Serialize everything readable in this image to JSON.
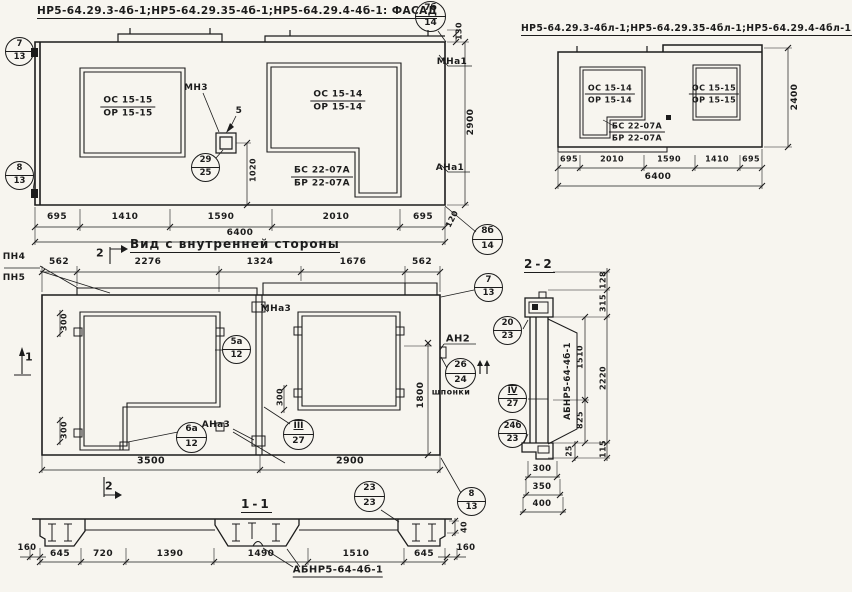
{
  "colors": {
    "ink": "#1c1c1c",
    "paper": "#f7f5ef"
  },
  "titles": {
    "facade_left": "НР5-64.29.3-4б-1;НР5-64.29.35-4б-1;НР5-64.29.4-4б-1: ФАСАД",
    "facade_right": "НР5-64.29.3-4бл-1;НР5-64.29.35-4бл-1;НР5-64.29.4-4бл-1.ФАСАД",
    "inner_view": "Вид с внутренней стороны",
    "section_2_2": "2-2",
    "section_1_1": "1-1"
  },
  "fractions": [
    {
      "top": "ОС 15-15",
      "bottom": "ОР 15-15",
      "x": 128,
      "y": 107,
      "small": false
    },
    {
      "top": "ОС 15-14",
      "bottom": "ОР 15-14",
      "x": 338,
      "y": 101,
      "small": false
    },
    {
      "top": "БС 22-07А",
      "bottom": "БР 22-07А",
      "x": 322,
      "y": 177,
      "small": false
    },
    {
      "top": "ОС 15-14",
      "bottom": "ОР 15-14",
      "x": 610,
      "y": 94,
      "small": true
    },
    {
      "top": "ОС 15-15",
      "bottom": "ОР 15-15",
      "x": 714,
      "y": 94,
      "small": true
    },
    {
      "top": "БС 22-07А",
      "bottom": "БР 22-07А",
      "x": 637,
      "y": 132,
      "small": true
    }
  ],
  "balloons": [
    {
      "top": "7б",
      "bottom": "14",
      "x": 431,
      "y": 17,
      "r": 16
    },
    {
      "top": "7",
      "bottom": "13",
      "x": 20,
      "y": 52,
      "r": 15
    },
    {
      "top": "8",
      "bottom": "13",
      "x": 20,
      "y": 176,
      "r": 15
    },
    {
      "top": "29",
      "bottom": "25",
      "x": 206,
      "y": 168,
      "r": 15
    },
    {
      "top": "8б",
      "bottom": "14",
      "x": 488,
      "y": 240,
      "r": 16
    },
    {
      "top": "5а",
      "bottom": "12",
      "x": 237,
      "y": 350,
      "r": 15
    },
    {
      "top": "6а",
      "bottom": "12",
      "x": 192,
      "y": 438,
      "r": 16
    },
    {
      "top": "III",
      "bottom": "27",
      "x": 299,
      "y": 435,
      "r": 16,
      "roman": true
    },
    {
      "top": "7",
      "bottom": "13",
      "x": 489,
      "y": 288,
      "r": 15
    },
    {
      "top": "26",
      "bottom": "24",
      "x": 461,
      "y": 374,
      "r": 16
    },
    {
      "top": "20",
      "bottom": "23",
      "x": 508,
      "y": 331,
      "r": 15
    },
    {
      "top": "IV",
      "bottom": "27",
      "x": 513,
      "y": 399,
      "r": 15,
      "roman": true
    },
    {
      "top": "24б",
      "bottom": "23",
      "x": 513,
      "y": 434,
      "r": 15
    },
    {
      "top": "23",
      "bottom": "23",
      "x": 370,
      "y": 497,
      "r": 16
    },
    {
      "top": "8",
      "bottom": "13",
      "x": 472,
      "y": 502,
      "r": 15
    }
  ],
  "texts": [
    {
      "t": "130",
      "x": 459,
      "y": 31,
      "rot": -90,
      "fs": 8,
      "name": "dim-parapet-130"
    },
    {
      "t": "МНа1",
      "x": 452,
      "y": 62,
      "fs": 9,
      "name": "anchor-label-mna1"
    },
    {
      "t": "2900",
      "x": 471,
      "y": 122,
      "rot": -90,
      "fs": 9,
      "name": "dim-height-2900"
    },
    {
      "t": "АНа1",
      "x": 450,
      "y": 168,
      "fs": 9,
      "name": "anchor-label-ana1"
    },
    {
      "t": "120",
      "x": 452,
      "y": 219,
      "rot": -62,
      "fs": 8,
      "name": "dim-120"
    },
    {
      "t": "МН3",
      "x": 196,
      "y": 88,
      "fs": 9,
      "name": "anchor-label-mn3"
    },
    {
      "t": "5",
      "x": 239,
      "y": 111,
      "fs": 9,
      "name": "dim-5"
    },
    {
      "t": "1020",
      "x": 253,
      "y": 170,
      "rot": -90,
      "fs": 8,
      "name": "dim-1020"
    },
    {
      "t": "695",
      "x": 57,
      "y": 217,
      "fs": 9,
      "name": "dim-695"
    },
    {
      "t": "1410",
      "x": 125,
      "y": 217,
      "fs": 9,
      "name": "dim-1410"
    },
    {
      "t": "1590",
      "x": 221,
      "y": 217,
      "fs": 9,
      "name": "dim-1590"
    },
    {
      "t": "2010",
      "x": 336,
      "y": 217,
      "fs": 9,
      "name": "dim-2010"
    },
    {
      "t": "695",
      "x": 423,
      "y": 217,
      "fs": 9,
      "name": "dim-695"
    },
    {
      "t": "6400",
      "x": 240,
      "y": 233,
      "fs": 9,
      "name": "dim-total-6400"
    },
    {
      "t": "695",
      "x": 569,
      "y": 159,
      "fs": 8,
      "name": "dim-695"
    },
    {
      "t": "2010",
      "x": 612,
      "y": 159,
      "fs": 8,
      "name": "dim-2010"
    },
    {
      "t": "1590",
      "x": 669,
      "y": 159,
      "fs": 8,
      "name": "dim-1590"
    },
    {
      "t": "1410",
      "x": 717,
      "y": 159,
      "fs": 8,
      "name": "dim-1410"
    },
    {
      "t": "695",
      "x": 751,
      "y": 159,
      "fs": 8,
      "name": "dim-695"
    },
    {
      "t": "6400",
      "x": 658,
      "y": 177,
      "fs": 9,
      "name": "dim-total-6400"
    },
    {
      "t": "2400",
      "x": 795,
      "y": 97,
      "rot": -90,
      "fs": 9,
      "name": "dim-height-2400"
    },
    {
      "t": "ПН4",
      "x": 14,
      "y": 257,
      "fs": 9,
      "name": "anchor-label-pn4"
    },
    {
      "t": "ПН5",
      "x": 14,
      "y": 278,
      "fs": 9,
      "name": "anchor-label-pn5"
    },
    {
      "t": "562",
      "x": 59,
      "y": 262,
      "fs": 9,
      "name": "dim-562"
    },
    {
      "t": "2276",
      "x": 148,
      "y": 262,
      "fs": 9,
      "name": "dim-2276"
    },
    {
      "t": "1324",
      "x": 260,
      "y": 262,
      "fs": 9,
      "name": "dim-1324"
    },
    {
      "t": "1676",
      "x": 353,
      "y": 262,
      "fs": 9,
      "name": "dim-1676"
    },
    {
      "t": "562",
      "x": 422,
      "y": 262,
      "fs": 9,
      "name": "dim-562"
    },
    {
      "t": "2",
      "x": 100,
      "y": 253,
      "fs": 11,
      "name": "section-marker-2"
    },
    {
      "t": "300",
      "x": 64,
      "y": 322,
      "rot": -90,
      "fs": 8,
      "name": "dim-300"
    },
    {
      "t": "300",
      "x": 64,
      "y": 430,
      "rot": -90,
      "fs": 8,
      "name": "dim-300"
    },
    {
      "t": "МНа3",
      "x": 276,
      "y": 309,
      "fs": 9,
      "name": "anchor-label-mna3"
    },
    {
      "t": "АНа3",
      "x": 216,
      "y": 425,
      "fs": 9,
      "name": "anchor-label-ana3"
    },
    {
      "t": "300",
      "x": 280,
      "y": 397,
      "rot": -90,
      "fs": 8,
      "name": "dim-300"
    },
    {
      "t": "1800",
      "x": 421,
      "y": 395,
      "rot": -90,
      "fs": 9,
      "name": "dim-1800"
    },
    {
      "t": "АН2",
      "x": 458,
      "y": 339,
      "fs": 10,
      "name": "anchor-label-an2"
    },
    {
      "t": "шпонки",
      "x": 451,
      "y": 392,
      "fs": 8,
      "name": "label-shponki"
    },
    {
      "t": "3500",
      "x": 151,
      "y": 461,
      "fs": 9.5,
      "name": "dim-3500"
    },
    {
      "t": "2900",
      "x": 350,
      "y": 461,
      "fs": 9.5,
      "name": "dim-2900"
    },
    {
      "t": "1",
      "x": 29,
      "y": 357,
      "fs": 11,
      "name": "section-marker-1"
    },
    {
      "t": "2",
      "x": 109,
      "y": 486,
      "fs": 11,
      "name": "section-marker-2"
    },
    {
      "t": "128",
      "x": 603,
      "y": 280,
      "rot": -90,
      "fs": 8,
      "name": "dim-128"
    },
    {
      "t": "315",
      "x": 603,
      "y": 303,
      "rot": -90,
      "fs": 8,
      "name": "dim-315"
    },
    {
      "t": "1510",
      "x": 580,
      "y": 357,
      "rot": -90,
      "fs": 8,
      "name": "dim-1510"
    },
    {
      "t": "825",
      "x": 580,
      "y": 420,
      "rot": -90,
      "fs": 8,
      "name": "dim-825"
    },
    {
      "t": "2220",
      "x": 603,
      "y": 378,
      "rot": -90,
      "fs": 8,
      "name": "dim-2220"
    },
    {
      "t": "АБНР5-64-4б-1",
      "x": 568,
      "y": 381,
      "rot": -90,
      "fs": 8.5,
      "name": "label-abnr-beam"
    },
    {
      "t": "25",
      "x": 569,
      "y": 451,
      "rot": -90,
      "fs": 7.5,
      "name": "dim-25"
    },
    {
      "t": "115",
      "x": 603,
      "y": 449,
      "rot": -90,
      "fs": 8,
      "name": "dim-115"
    },
    {
      "t": "300",
      "x": 542,
      "y": 469,
      "fs": 8.5,
      "name": "dim-300"
    },
    {
      "t": "350",
      "x": 542,
      "y": 487,
      "fs": 8.5,
      "name": "dim-350"
    },
    {
      "t": "400",
      "x": 542,
      "y": 504,
      "fs": 8.5,
      "name": "dim-400"
    },
    {
      "t": "160",
      "x": 27,
      "y": 548,
      "fs": 8.5,
      "name": "dim-160"
    },
    {
      "t": "645",
      "x": 60,
      "y": 554,
      "fs": 9,
      "name": "dim-645"
    },
    {
      "t": "720",
      "x": 103,
      "y": 554,
      "fs": 9,
      "name": "dim-720"
    },
    {
      "t": "1390",
      "x": 170,
      "y": 554,
      "fs": 9,
      "name": "dim-1390"
    },
    {
      "t": "1490",
      "x": 261,
      "y": 554,
      "fs": 9,
      "name": "dim-1490"
    },
    {
      "t": "1510",
      "x": 356,
      "y": 554,
      "fs": 9,
      "name": "dim-1510"
    },
    {
      "t": "645",
      "x": 424,
      "y": 554,
      "fs": 9,
      "name": "dim-645"
    },
    {
      "t": "160",
      "x": 466,
      "y": 548,
      "fs": 8.5,
      "name": "dim-160"
    },
    {
      "t": "40",
      "x": 464,
      "y": 527,
      "rot": -90,
      "fs": 8,
      "name": "dim-40"
    },
    {
      "t": "АБНР5-64-4б-1",
      "x": 338,
      "y": 571,
      "fs": 10,
      "u": 1,
      "name": "label-abnr-beam"
    }
  ]
}
